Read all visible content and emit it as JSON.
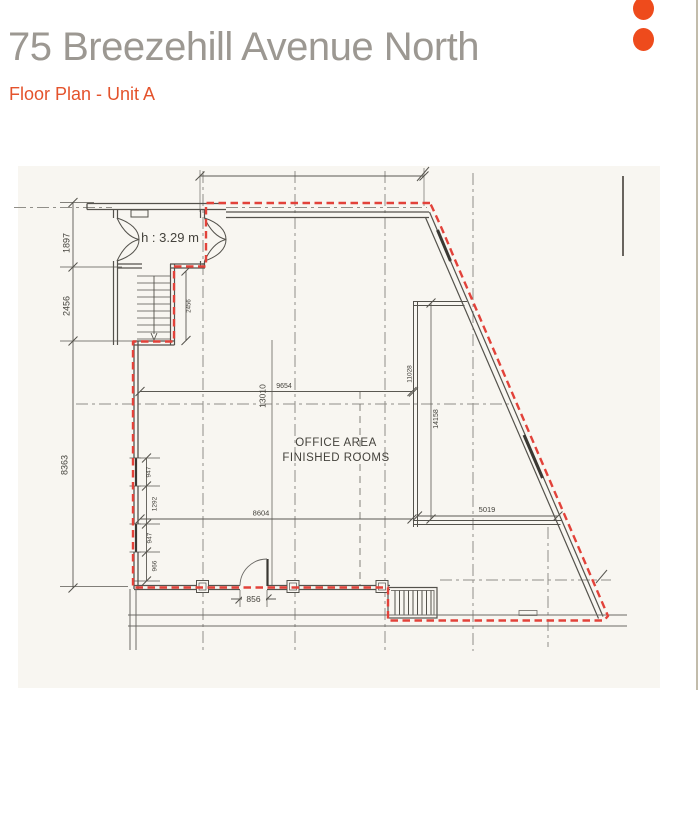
{
  "page": {
    "title": "75 Breezehill Avenue North",
    "subtitle": "Floor Plan - Unit A"
  },
  "branding": {
    "accent_color": "#EE4B1C",
    "dot_count": 2
  },
  "floor_plan": {
    "labels": {
      "office_area_line1": "OFFICE AREA",
      "office_area_line2": "FINISHED ROOMS",
      "ceiling_height": "h : 3.29 m"
    },
    "dimensions": {
      "left_upper": "1897",
      "left_stairwell": "2456",
      "left_main": "8363",
      "stair_run": "2456",
      "window_upper": "947",
      "pier_mid": "1292",
      "window_lower": "947",
      "base_segment": "966",
      "width_upper": "9654",
      "width_overall": "13010",
      "width_lower": "8604",
      "door_opening": "856",
      "right_room_depth": "14158",
      "right_wall_upper": "11028",
      "right_room_width": "5019"
    },
    "colors": {
      "unit_boundary": "#E2423A",
      "linework": "#55534C",
      "scan_background": "#F8F6F1"
    }
  }
}
